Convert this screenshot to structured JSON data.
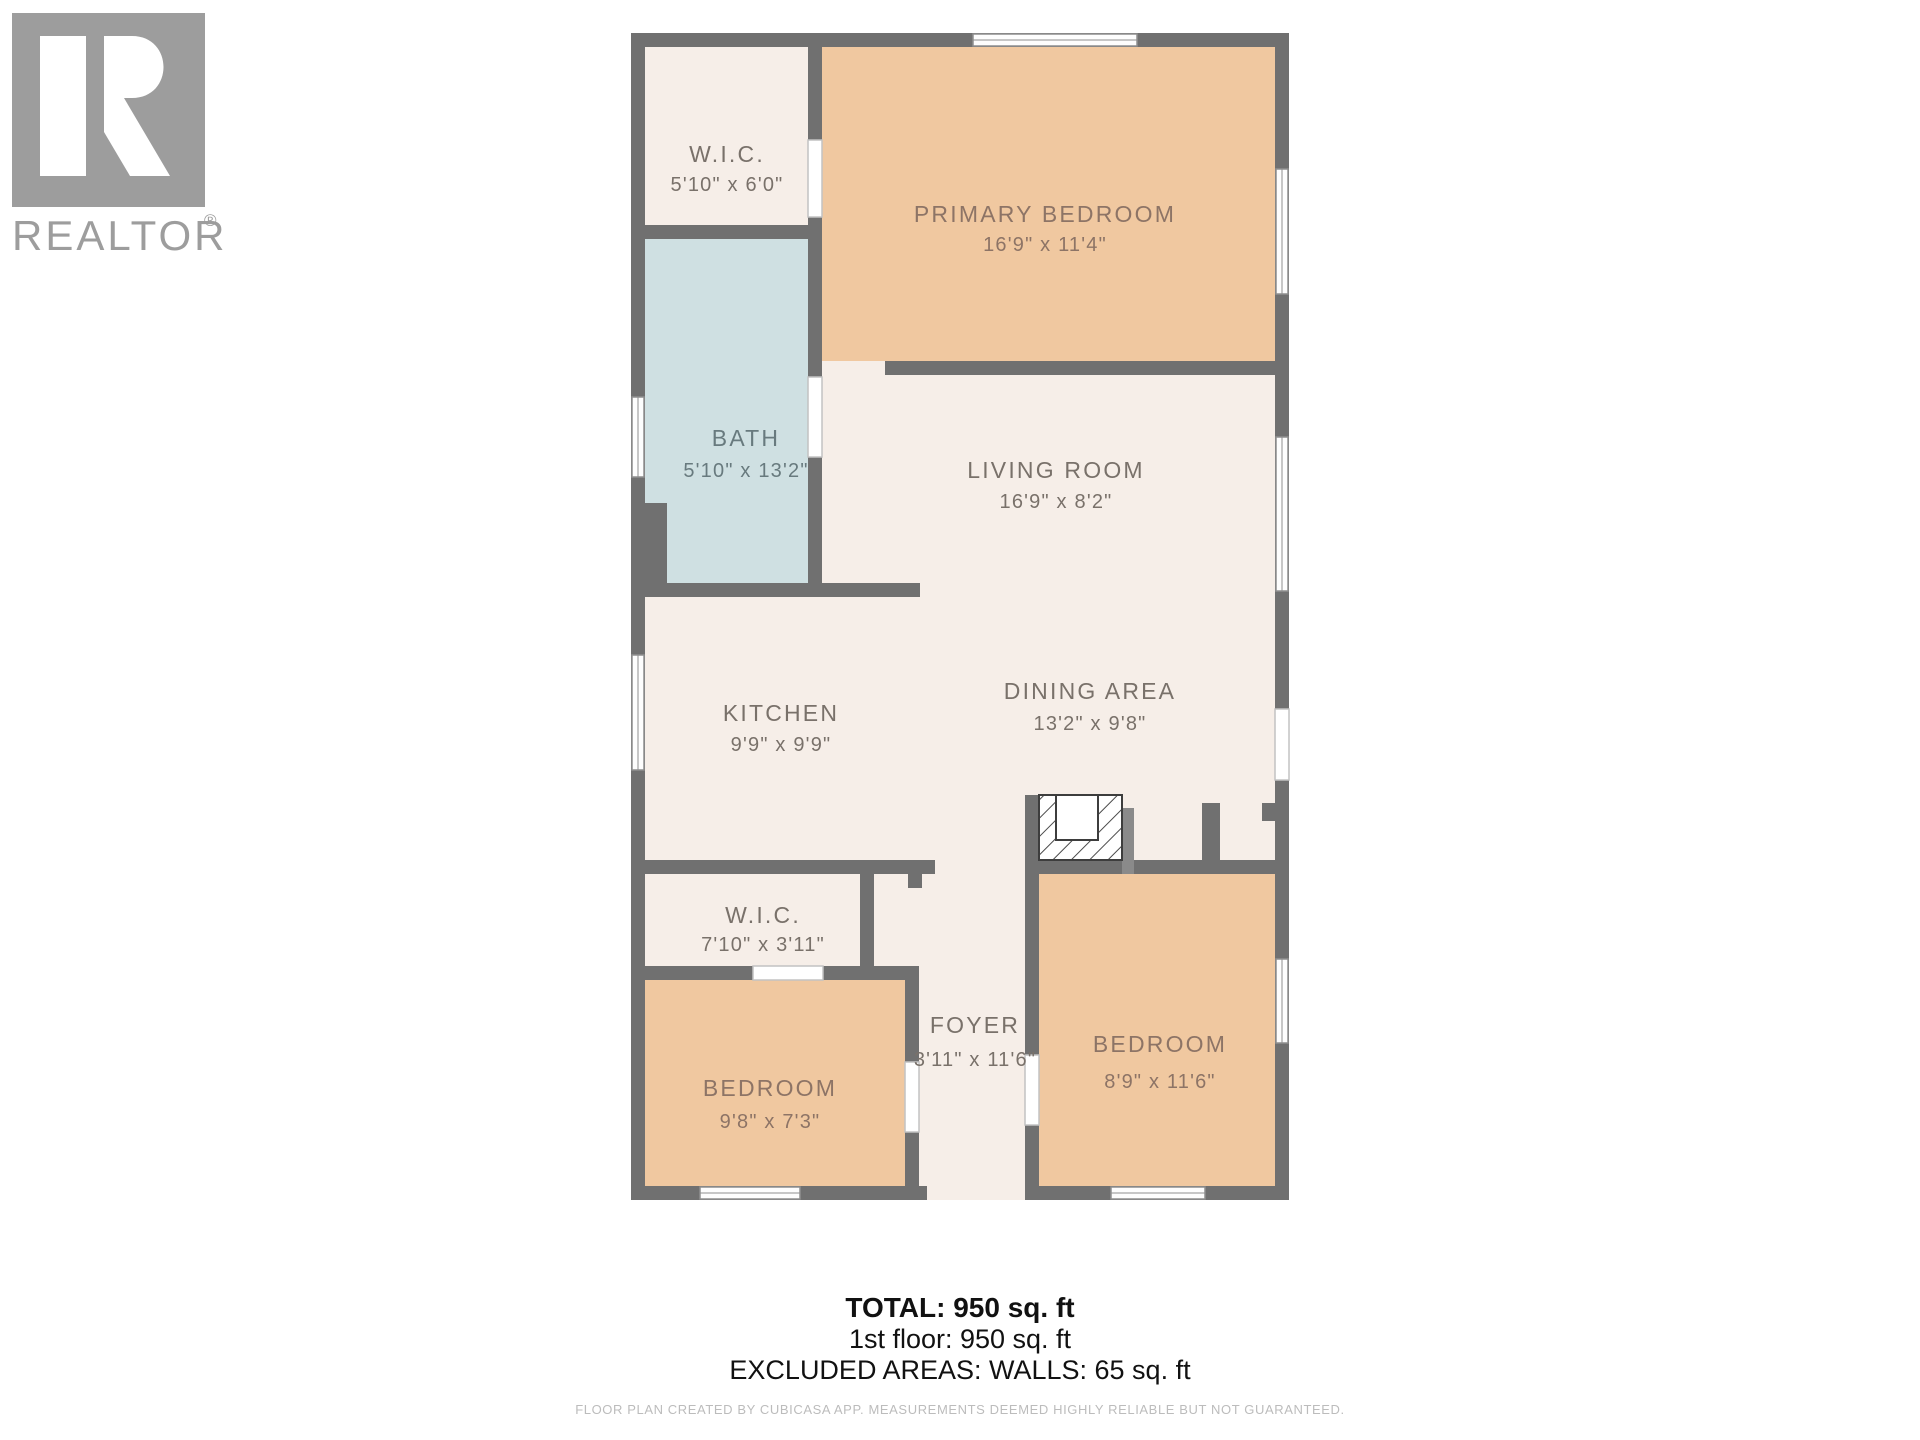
{
  "branding": {
    "logo_letter": "R",
    "logo_text": "REALTOR",
    "registered_mark": "®"
  },
  "rooms": {
    "wic_top": {
      "name": "W.I.C.",
      "dims": "5'10\" x 6'0\""
    },
    "primary_bedroom": {
      "name": "PRIMARY BEDROOM",
      "dims": "16'9\" x 11'4\""
    },
    "bath": {
      "name": "BATH",
      "dims": "5'10\" x 13'2\""
    },
    "living_room": {
      "name": "LIVING ROOM",
      "dims": "16'9\" x 8'2\""
    },
    "kitchen": {
      "name": "KITCHEN",
      "dims": "9'9\" x 9'9\""
    },
    "dining_area": {
      "name": "DINING AREA",
      "dims": "13'2\" x 9'8\""
    },
    "wic_lower": {
      "name": "W.I.C.",
      "dims": "7'10\" x 3'11\""
    },
    "foyer": {
      "name": "FOYER",
      "dims": "3'11\" x 11'6\""
    },
    "bedroom_left": {
      "name": "BEDROOM",
      "dims": "9'8\" x 7'3\""
    },
    "bedroom_right": {
      "name": "BEDROOM",
      "dims": "8'9\" x 11'6\""
    }
  },
  "summary": {
    "total": "TOTAL: 950 sq. ft",
    "first_floor": "1st floor: 950 sq. ft",
    "excluded": "EXCLUDED AREAS: WALLS: 65 sq. ft"
  },
  "footer": {
    "disclaimer": "FLOOR PLAN CREATED BY CUBICASA APP. MEASUREMENTS DEEMED HIGHLY RELIABLE BUT NOT GUARANTEED."
  },
  "colors": {
    "wall": "#707070",
    "room_cream": "#f6eee8",
    "room_peach": "#f0c8a0",
    "room_bath_blue": "#cfe0e2",
    "label_text": "#79716a",
    "logo_gray": "#9d9d9d",
    "summary_text": "#111111",
    "disclaimer_gray": "#bcbcbc"
  }
}
